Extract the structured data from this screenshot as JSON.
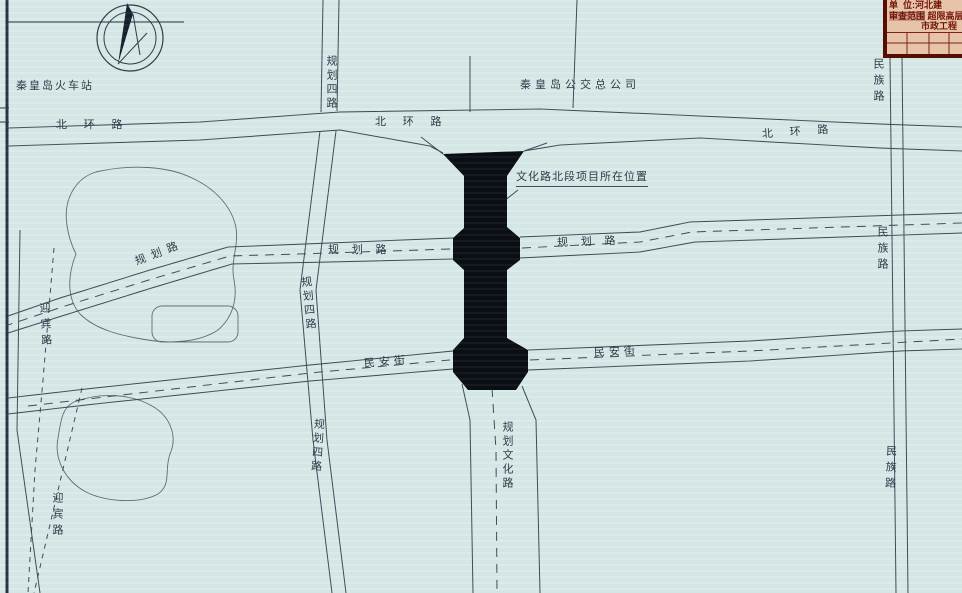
{
  "title_block": {
    "line1": "单  位:河北建",
    "line2_label": "审查范围",
    "line2_value": " 超限高层",
    "line3": "市政工程"
  },
  "labels": {
    "railway_station": "秦皇岛火车站",
    "bus_company": "秦皇岛公交总公司",
    "project_location": "文化路北段项目所在位置",
    "beihuan_left": "北 环 路",
    "beihuan_center": "北 环 路",
    "beihuan_right": "北 环 路",
    "guihua_left": "规划路",
    "guihua_mid": "规 划 路",
    "guihua_right": "规 划 路",
    "minan_left": "民安街",
    "minan_right": "民安街",
    "silu_top": "规划四路",
    "silu_mid": "规划四路",
    "silu_bottom": "规划四路",
    "wenhua": "规划文化路",
    "minzu_top": "民族路",
    "minzu_mid": "民族路",
    "minzu_bottom": "民族路",
    "yingbin_top": "迎宾路",
    "yingbin_bottom": "迎宾路"
  },
  "colors": {
    "background": "#d8eae8",
    "linework": "#3d4a57",
    "project_fill": "#0a0e14",
    "title_block_bg": "#e7c3aa",
    "title_block_text": "#731508",
    "title_block_border": "#550e04"
  },
  "icons": {
    "compass": "compass-north-arrow"
  }
}
